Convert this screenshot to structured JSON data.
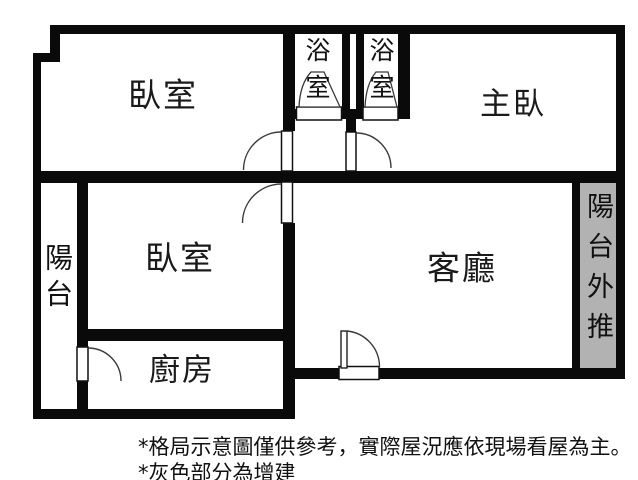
{
  "floorplan": {
    "rooms": {
      "bedroom_top": {
        "label": "臥室"
      },
      "bathroom_1": {
        "label": "浴室"
      },
      "bathroom_2": {
        "label": "浴室"
      },
      "master_bedroom": {
        "label": "主臥"
      },
      "balcony_left": {
        "label": "陽台"
      },
      "bedroom_mid": {
        "label": "臥室"
      },
      "living_room": {
        "label": "客廳"
      },
      "kitchen": {
        "label": "廚房"
      },
      "balcony_extension": {
        "label": "陽台外推"
      }
    },
    "notes": [
      "*格局示意圖僅供參考，實際屋況應依現場看屋為主。",
      "*灰色部分為增建"
    ],
    "colors": {
      "wall": "#0a0a0a",
      "background": "#ffffff",
      "extension_fill": "#b2b2b2"
    }
  }
}
